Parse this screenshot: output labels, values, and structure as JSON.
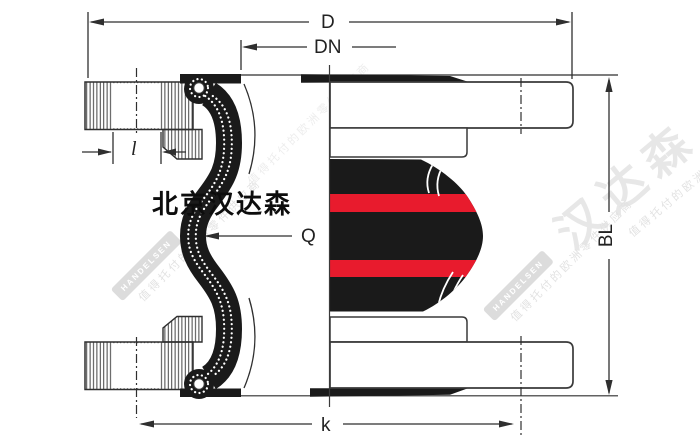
{
  "title": "Rubber expansion joint technical drawing (section + external view)",
  "brand": {
    "overlay_text": "北京汉达森"
  },
  "dimensions": {
    "outer_diameter": {
      "label": "D"
    },
    "nominal_diameter": {
      "label": "DN"
    },
    "bolt_hole": {
      "label": "l"
    },
    "arch_width": {
      "label": "Q"
    },
    "bolt_circle": {
      "label": "k"
    },
    "build_length": {
      "label": "BL"
    }
  },
  "watermark": {
    "big_text": "汉达森",
    "box_text": "HANDELSEN",
    "tagline": "值得托付的欧洲零件供应商"
  },
  "colors": {
    "line": "#2f2f2f",
    "rubber_black": "#1a1a1a",
    "stripe_red": "#e81b2d",
    "watermark_gray": "#e3e3e3"
  }
}
